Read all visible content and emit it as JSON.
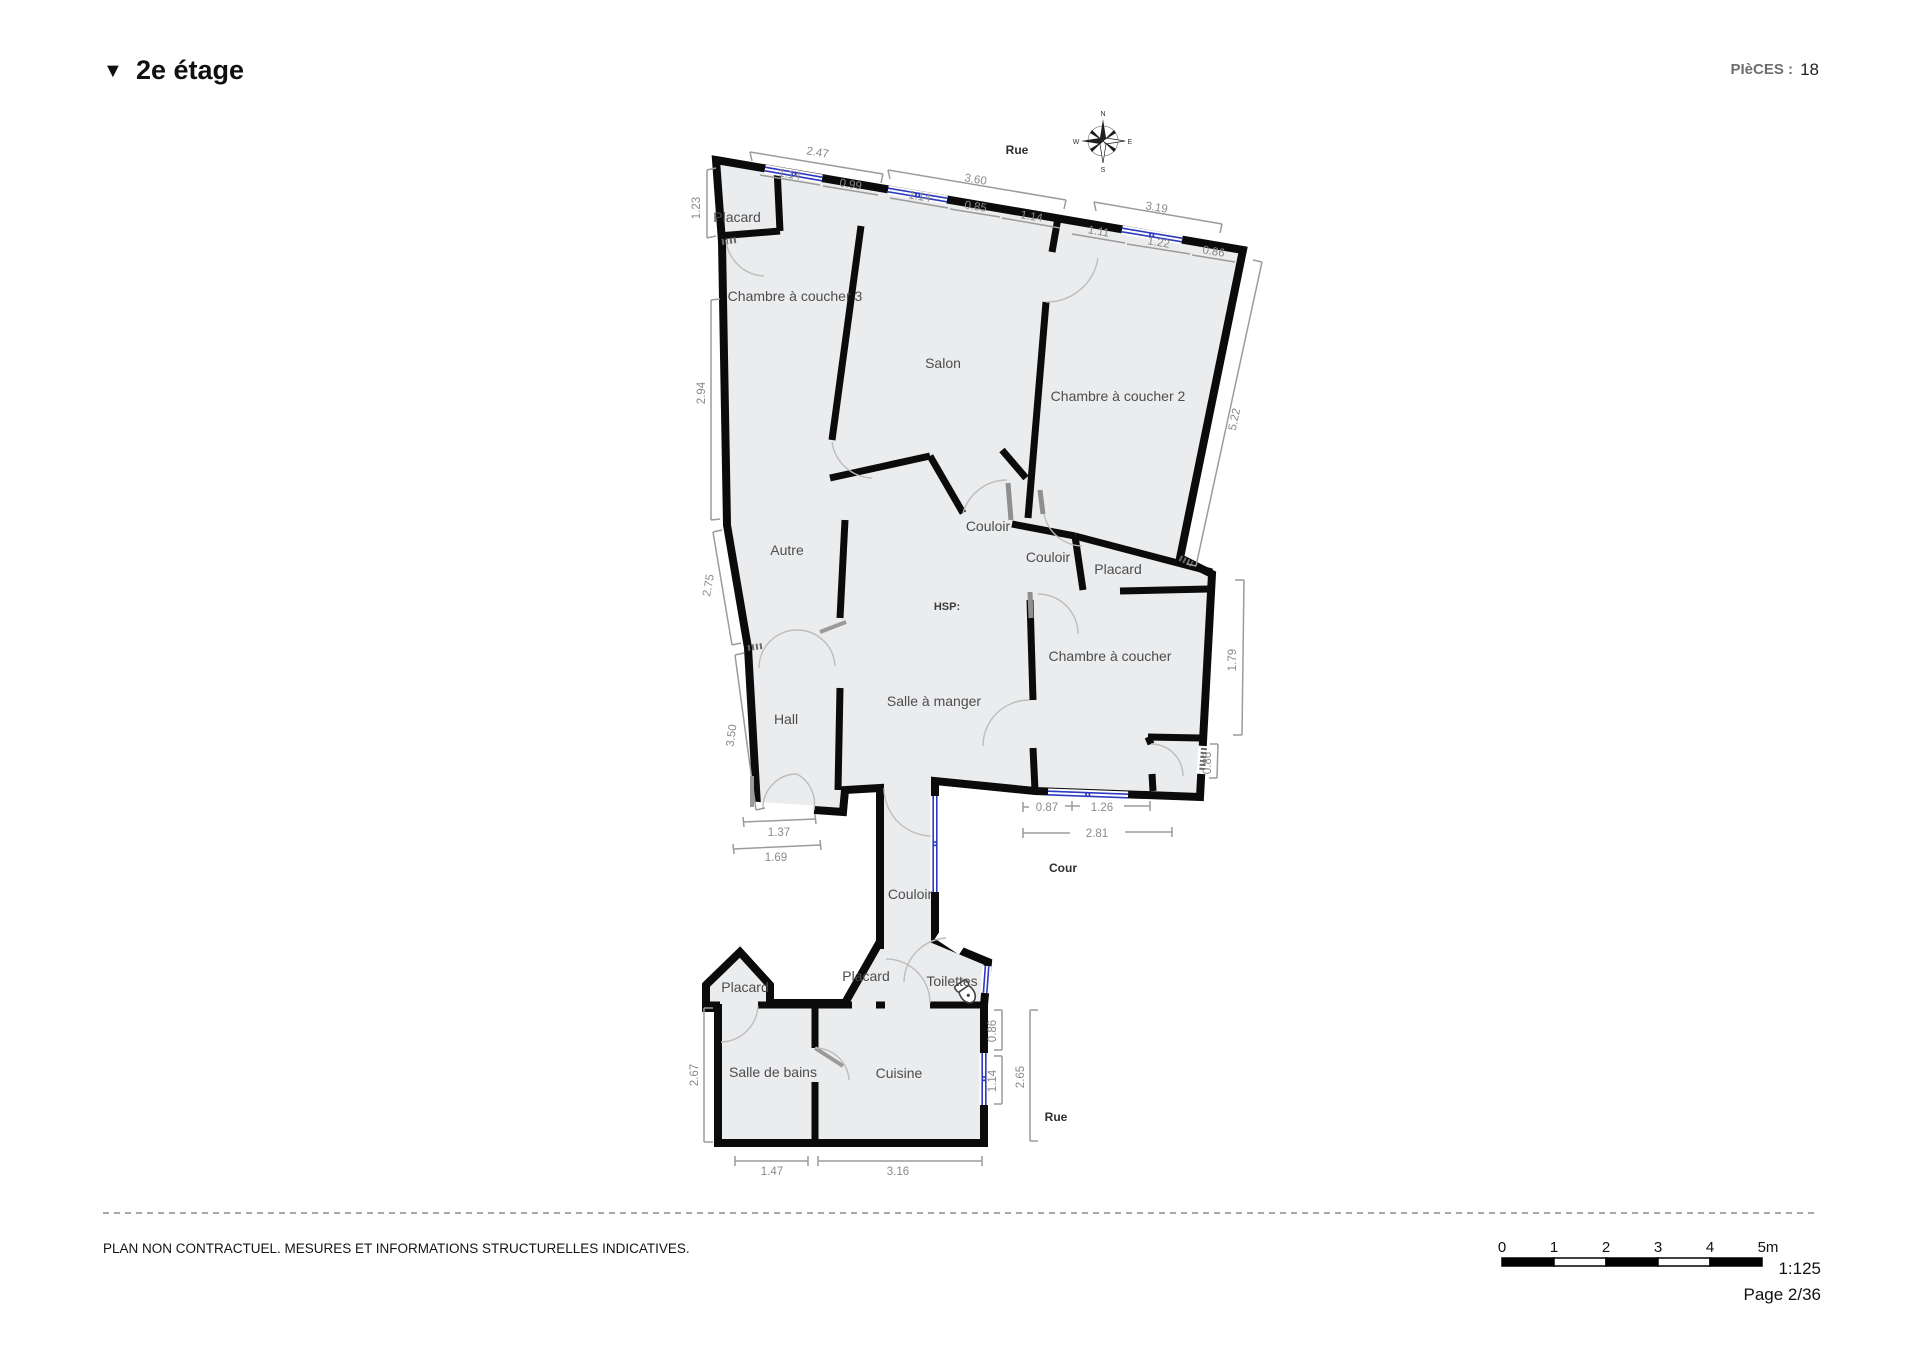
{
  "header": {
    "collapse_marker": "▼",
    "title": "2e étage",
    "pieces_label": "PIèCES :",
    "pieces_value": "18"
  },
  "compass": {
    "north": "N",
    "east": "E",
    "south": "S",
    "west": "W"
  },
  "context": {
    "rue_top": "Rue",
    "cour": "Cour",
    "rue_bottom": "Rue"
  },
  "rooms": [
    "Placard",
    "Chambre à coucher 3",
    "Salon",
    "Chambre à coucher 2",
    "Couloir",
    "Couloir",
    "Placard",
    "HSP:",
    "Chambre à coucher",
    "Autre",
    "Hall",
    "Salle à manger",
    "Couloir",
    "Placard",
    "Toilettes",
    "Placard",
    "Salle de bains",
    "Cuisine"
  ],
  "dims": {
    "top": [
      "2.47",
      "1.14",
      "0.99",
      "3.60",
      "1.14",
      "0.85",
      "1.14",
      "3.19",
      "1.11",
      "1.22",
      "0.86"
    ],
    "left": [
      "1.23",
      "2.94",
      "2.75",
      "3.50",
      "2.67"
    ],
    "right": [
      "5.22",
      "1.79",
      "0.86",
      "0.86",
      "1.14",
      "2.65"
    ],
    "inner": [
      "0.87",
      "1.26",
      "2.81",
      "1.37",
      "1.69",
      "1.47",
      "3.16"
    ]
  },
  "footer": {
    "disclaimer": "PLAN NON CONTRACTUEL. MESURES ET INFORMATIONS STRUCTURELLES INDICATIVES.",
    "scale_ticks": [
      "0",
      "1",
      "2",
      "3",
      "4",
      "5m"
    ],
    "scale_ratio": "1:125",
    "page": "Page 2/36"
  }
}
